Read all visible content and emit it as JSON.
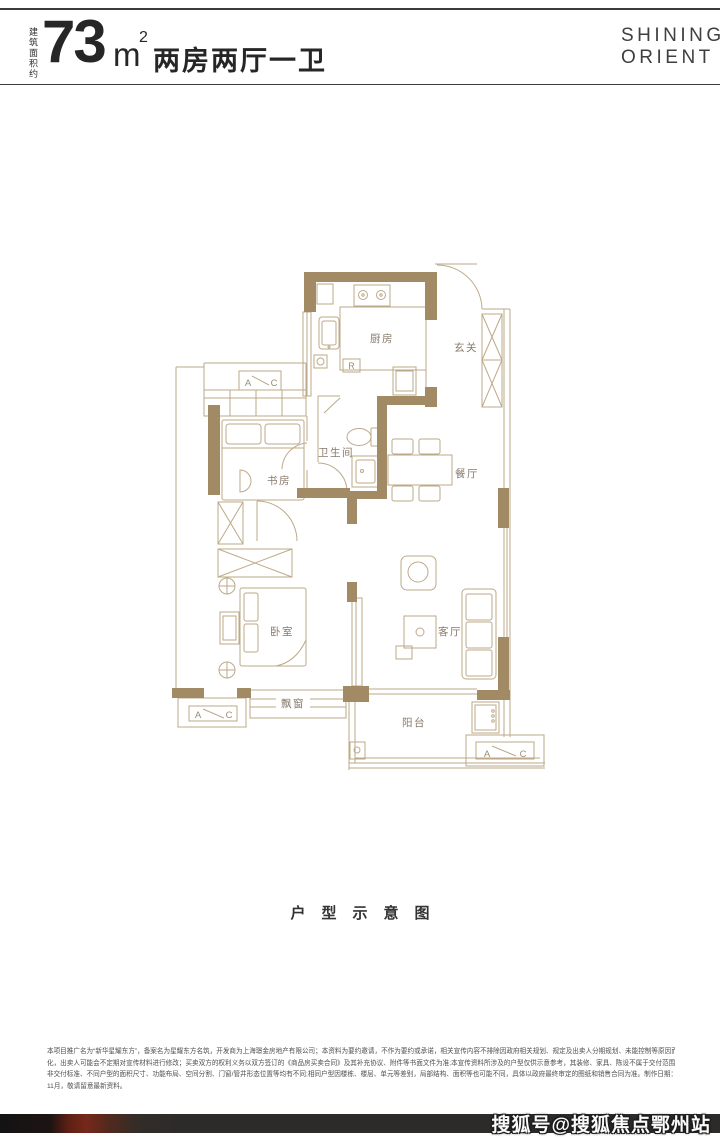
{
  "header": {
    "area_note": "建筑面积约",
    "area_value": "73",
    "area_unit": "m",
    "area_sup": "2",
    "layout_title": "两房两厅一卫"
  },
  "brand": {
    "line1": "SHINING",
    "line2": "ORIENT"
  },
  "floorplan": {
    "rooms": {
      "kitchen": "厨房",
      "foyer": "玄关",
      "bathroom": "卫生间",
      "dining": "餐厅",
      "study": "书房",
      "bedroom": "卧室",
      "living": "客厅",
      "bay_window": "飘窗",
      "balcony": "阳台"
    },
    "markers": {
      "fridge": "R",
      "ac_a": "A",
      "ac_c": "C"
    },
    "colors": {
      "wall": "#a28b64",
      "line": "#bda989",
      "label": "#87796a"
    }
  },
  "caption": "户型示意图",
  "disclaimer": {
    "lines": [
      "本项目推广名为“新华星耀东方”，备案名为星耀东方名筑，开发商为上海璟金房地产有限公司；本资料为要约邀请，不作为要约或承诺，相关宣传内容不排除因政府相关规划、规定及出卖人分期规划、未能控制等原因而发生变",
      "化，出卖人可能会不定期对宣传材料进行修改；买卖双方的权利义务以双方签订的《商品房买卖合同》及其补充协议、附件等书面文件为准;本宣传资料所涉及的户型仅供示意参考，其装修、家具、陈设不属于交付范围，也并",
      "非交付标准、不同户型的面积尺寸、功能布局、空间分割、门窗/管井形态位置等均有不同;相同户型因楼栋、楼层、单元等差别，局部结构、面积等也可能不同，具体以政府最终审定的图纸和销售合同为准。制作日期：2023年",
      "11月，敬请留意最新资料。"
    ]
  },
  "watermark": "搜狐号@搜狐焦点鄂州站"
}
